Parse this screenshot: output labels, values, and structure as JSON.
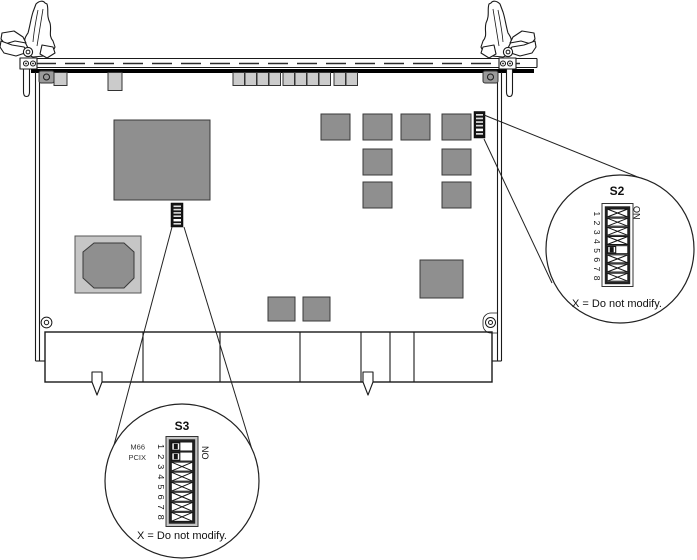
{
  "colors": {
    "bg": "#ffffff",
    "line": "#1a1a1a",
    "chip_fill": "#8f8f8f",
    "chip_stroke": "#3a3a3a",
    "frame_gray": "#c6c6c6",
    "connector_fill": "#cbcbcb",
    "switch_black": "#141414"
  },
  "callouts": {
    "s2": {
      "title": "S2",
      "on_label": "ON",
      "positions": "1 2 3 4 5 6 7 8",
      "rows": [
        "X",
        "X",
        "X",
        "X",
        "OFF",
        "X",
        "X",
        "X"
      ],
      "note": "X = Do not modify."
    },
    "s3": {
      "title": "S3",
      "on_label": "ON",
      "positions": "1 2 3 4 5 6 7 8",
      "row_labels": [
        "M66",
        "PCIX"
      ],
      "rows": [
        "OFF",
        "OFF",
        "X",
        "X",
        "X",
        "X",
        "X",
        "X"
      ],
      "note": "X = Do not modify."
    }
  }
}
